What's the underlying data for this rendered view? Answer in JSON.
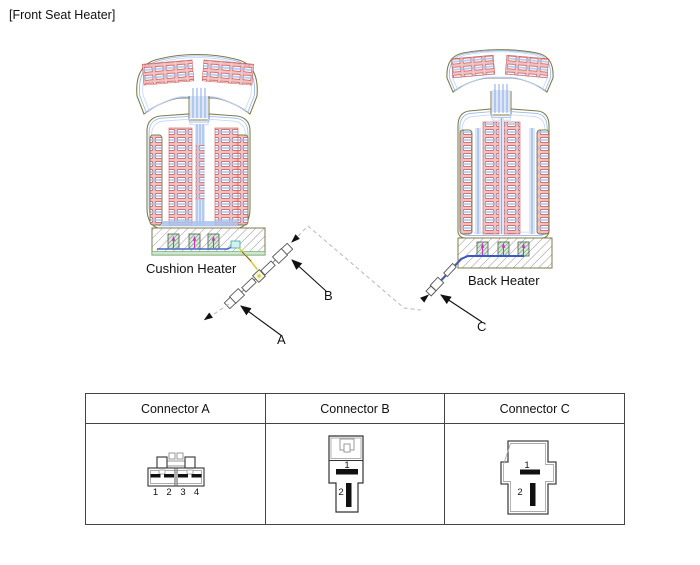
{
  "title": "[Front Seat Heater]",
  "diagram": {
    "cushion_heater_label": "Cushion Heater",
    "back_heater_label": "Back Heater",
    "connector_a_label": "A",
    "connector_b_label": "B",
    "connector_c_label": "C"
  },
  "table": {
    "headers": [
      "Connector A",
      "Connector B",
      "Connector C"
    ],
    "connector_a_pins": [
      "1",
      "2",
      "3",
      "4"
    ],
    "connector_b_pins": [
      "1",
      "2"
    ],
    "connector_c_pins": [
      "1",
      "2"
    ]
  },
  "colors": {
    "seat_outline_olive": "#7d7d4f",
    "wire_blue": "#7aa2e0",
    "channel_light_blue": "#dce6f8",
    "heater_cell_red": "#c94f4f",
    "heater_cell_pink": "#e89a9a",
    "hatch_gray": "#999999",
    "block_green": "#4e8f4e",
    "arrow_magenta": "#cc2fcc",
    "harness_yellow": "#dcc937",
    "power_wire_blue": "#3a57c9",
    "dashed_gray": "#b8b8b8",
    "text_black": "#111111"
  }
}
